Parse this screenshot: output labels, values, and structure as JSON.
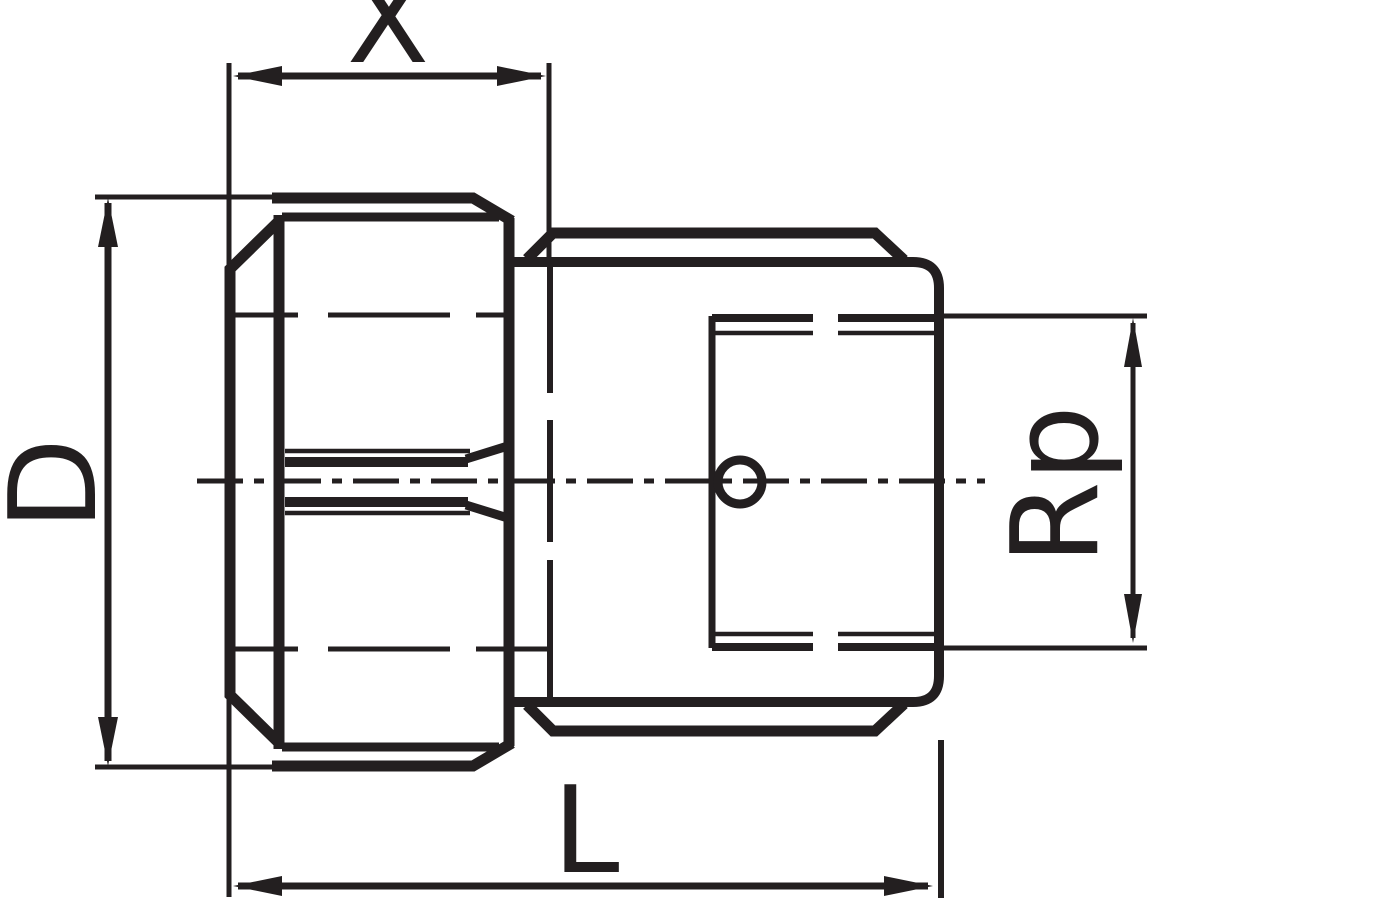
{
  "drawing": {
    "description": "Technical dimension drawing of a pipe fitting: union nut on left, socket body with internal Rp thread and weep hole on right",
    "labels": {
      "length_x": "X",
      "diameter_d": "D",
      "length_l": "L",
      "thread_rp": "Rp"
    },
    "colors": {
      "line": "#231f20",
      "background": "#ffffff"
    }
  }
}
